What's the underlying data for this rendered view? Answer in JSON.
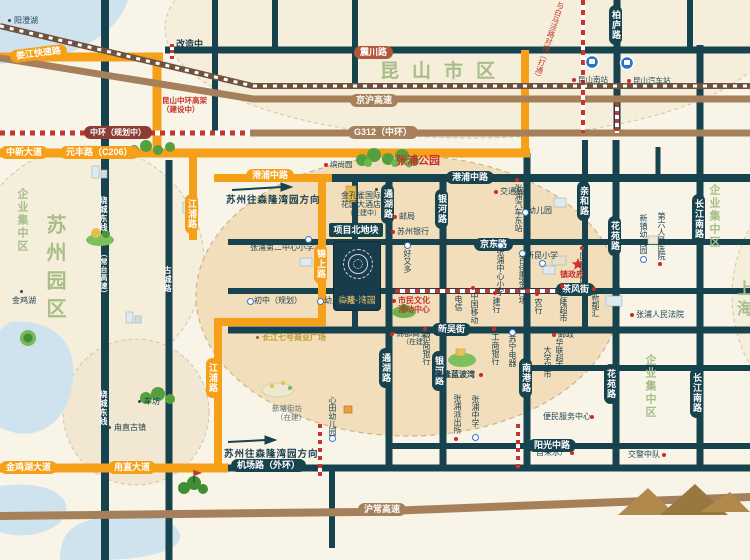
{
  "map": {
    "areas": {
      "kunshan_city": "昆山市区",
      "suzhou_park": "苏州园区",
      "enterprise_left": "企业集中区",
      "enterprise_right": "企业集中区",
      "enterprise_br": "企业集中区",
      "shanghai": "上海",
      "yangcheng_lake": "阳澄湖",
      "jinji_lake": "金鸡湖",
      "zhangpu_park": "张浦公园"
    },
    "roads": {
      "loujiang": "娄江快速路",
      "zhongxin": "中新大道",
      "yuanfeng": "元丰路（C206）",
      "gangpu_w": "港浦中路",
      "gangpu_e": "港浦中路",
      "jinshang": "锦上路",
      "jiangpu_n": "江浦路",
      "jiangpu_s": "江浦路",
      "jinjihu": "金鸡湖大道",
      "luzhi_ave": "甪直大道",
      "jinghu": "京沪高速",
      "g312": "G312（中环）",
      "huchang": "沪常高速",
      "zhenchuan": "震川路",
      "zhonghuan_planned": "中环（规划中）",
      "bailu": "柏庐路",
      "jingdong": "京东路",
      "changshou": "长寿路",
      "chafeng": "茶风街",
      "xinwu": "新吴街",
      "jichang": "机场路（外环）",
      "yangguang": "阳光中路",
      "tonghu_n": "通湖路",
      "tonghu_s": "通湖路",
      "yinhe_n": "银河路",
      "yinhe_s": "银河路",
      "qinhe": "亲和路",
      "huayuan_n": "花苑路",
      "huayuan_s": "花苑路",
      "changjiang_n": "长江南路",
      "changjiang_s": "长江南路",
      "nangang": "南港路",
      "raocheng_n": "绕城东线",
      "raocheng_paren": "（常台高速）",
      "raocheng_s": "绕城东线",
      "gucheng": "古城路"
    },
    "stations": {
      "south_station": "昆山南站",
      "bus_station": "昆山汽车站"
    },
    "project": {
      "logo": "森隆·湾园",
      "north_plot": "项目北地块",
      "lanbowan": "森隆蓝波湾"
    },
    "pois": {
      "binshangyuan": "缤尚园",
      "zhangpu_no2_primary": "张浦第二中心小学",
      "post_office": "邮局",
      "suzhou_bank": "苏州银行",
      "haoyouduo": "好又多",
      "traffic_bureau": "交通局",
      "east_bus_station": "张浦汽车东站",
      "kindergarten": "幼儿园",
      "xinkun_primary": "新昆小学",
      "town_gov": "镇政府",
      "power_grid": "国家电网",
      "xinzhen_kindergarten": "新镇幼儿园",
      "sixth_hospital": "第六人民医院",
      "people_court": "张浦人民法院",
      "xinduhui": "新都汇",
      "henglong_market": "恒隆超市",
      "abc_bank": "农行",
      "telecom": "电信",
      "china_mobile": "中国移动",
      "ccb_bank": "建行",
      "zhangpu_central_primary": "张浦中心小学",
      "baijiahui_plaza": "百佳惠金广场",
      "cmb_bank": "招商银行",
      "icbc_bank": "工商银行",
      "suning": "苏宁电器",
      "changjiang7_plaza": "长江七号商业广场",
      "middle_school_planned": "初中（规划）",
      "kindergarten_planned": "幼儿园（规划）",
      "xintian_kindergarten": "心田幼儿园",
      "police_station": "张浦派出所",
      "zhangpu_middle_school": "张浦中学",
      "convenience_center": "便民服务中心",
      "water_plant": "自来水厂",
      "traffic_police": "交警中队",
      "post": "邮政",
      "hualian_market": "华联超市",
      "daxue_market": "大学超市",
      "chefang": "车坊",
      "luzhi_town": "甪直古镇"
    },
    "annotations": {
      "renovating": "改造中",
      "viaduct_note": "昆山中环高架（建设中）",
      "baima_note": "与白马泾路对接（打通）",
      "direction_top": "苏州往森隆湾园方向",
      "direction_bottom": "苏州往森隆湾园方向",
      "hotel_line1": "金孔雀国际",
      "hotel_line2": "花园大酒店",
      "hotel_line3": "（在建中）",
      "xintang_line1": "新塘街坊",
      "xintang_line2": "（在建）",
      "shimin_line1": "市民文化",
      "shimin_line2": "活动中心",
      "jindu_line1": "锦都商业广场",
      "jindu_line2": "（在建）"
    },
    "colors": {
      "orange": "#f6a019",
      "highway_brown": "#a5805a",
      "road_navy": "#17434f",
      "planned_red": "#c9342b",
      "area_green": "#a8bd8a",
      "project_navy": "#183c4c",
      "project_gold": "#d8b96a",
      "peach": "#f2debb",
      "lake_blue": "#cfe3ef"
    }
  }
}
